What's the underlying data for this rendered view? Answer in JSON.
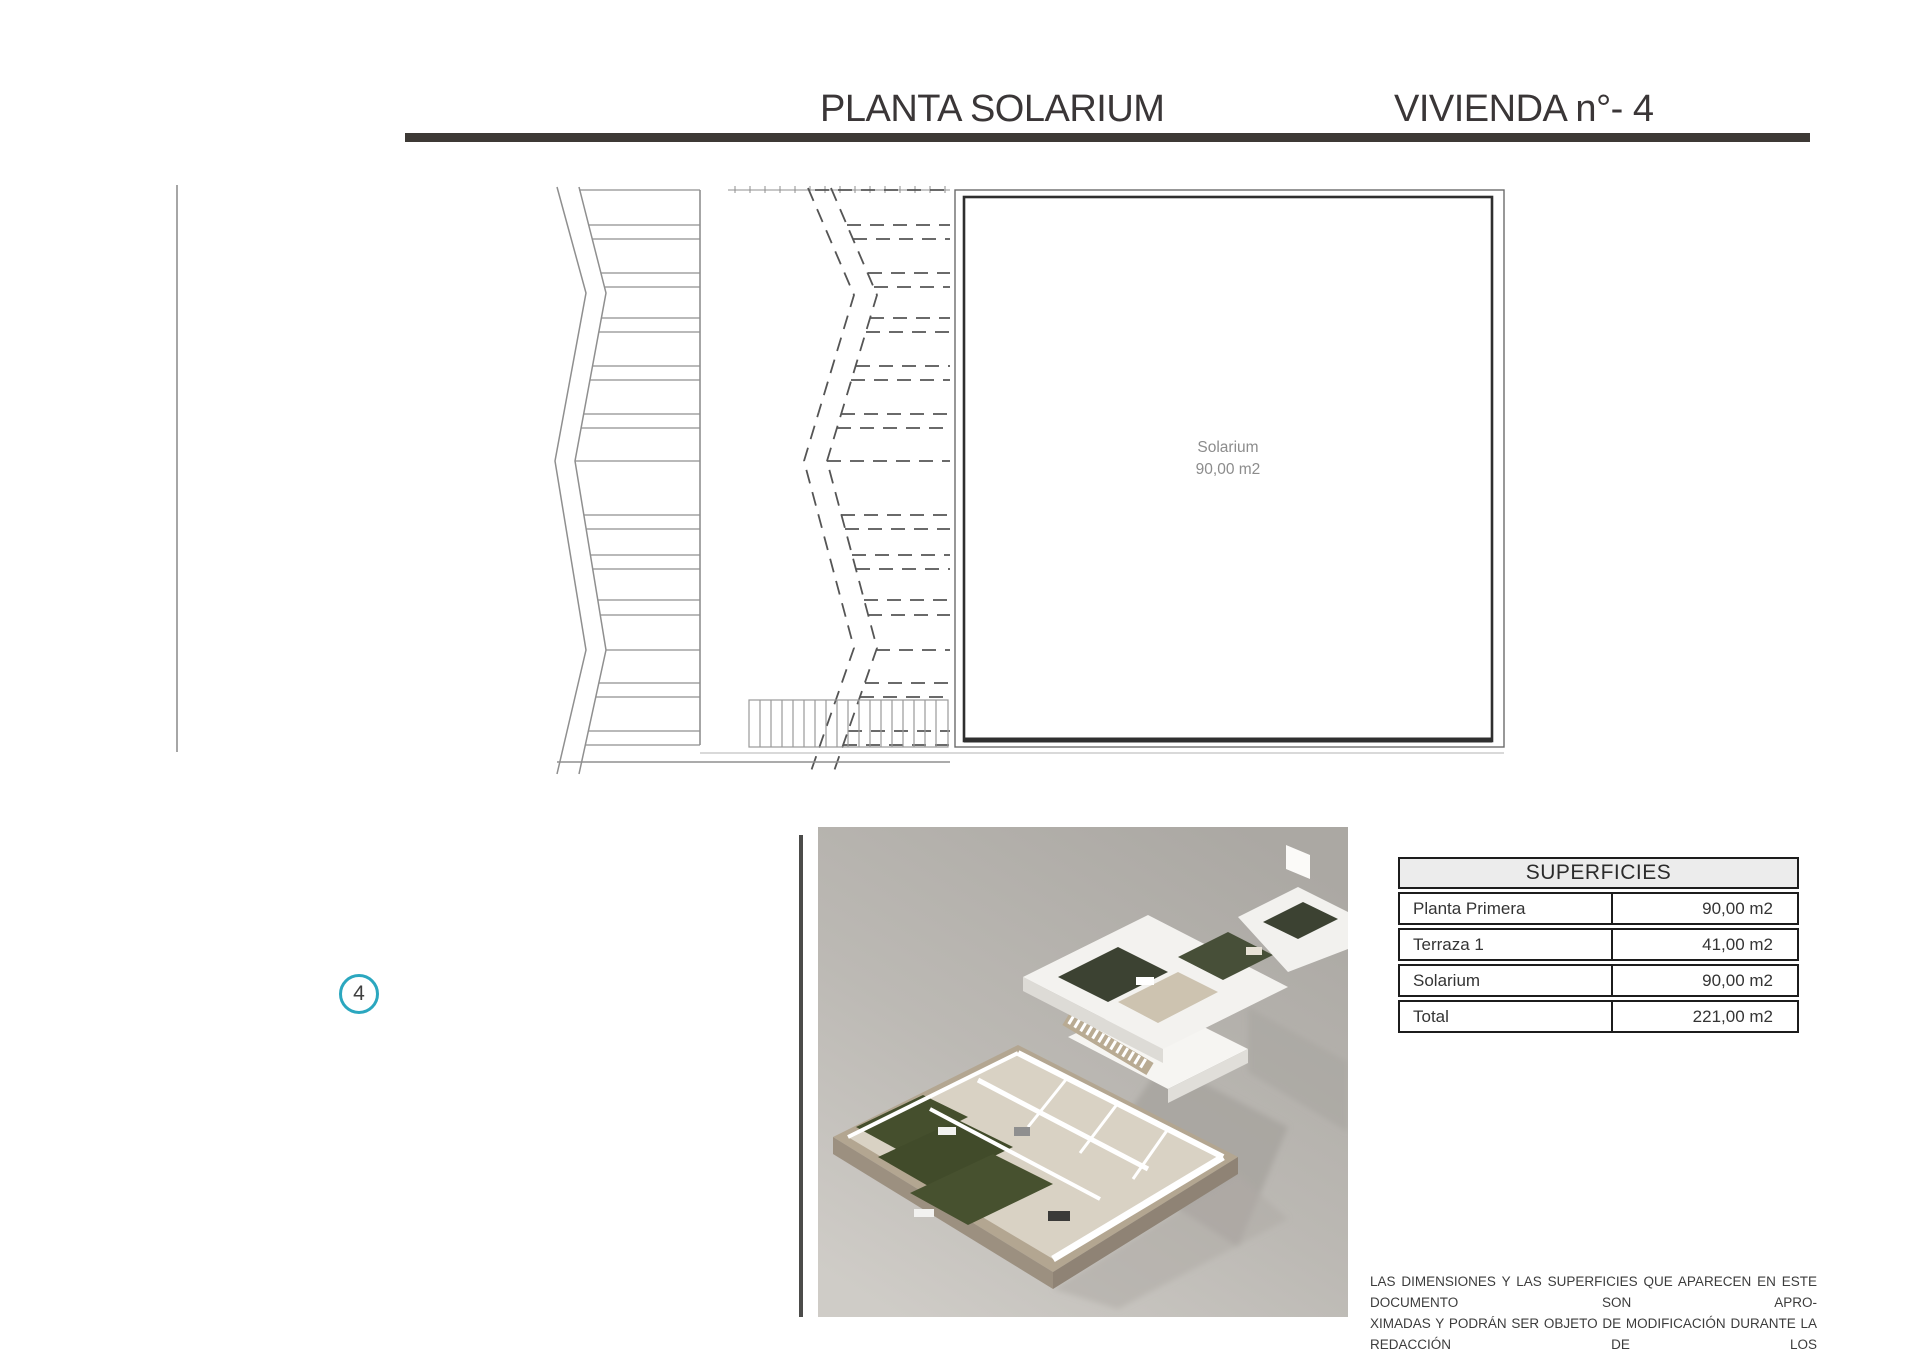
{
  "header": {
    "title_left": "PLANTA SOLARIUM",
    "title_right": "VIVIENDA n°- 4"
  },
  "plan": {
    "room_label": "Solarium",
    "room_area": "90,00 m2",
    "marker_number": "4"
  },
  "table": {
    "header": "SUPERFICIES",
    "rows": [
      {
        "label": "Planta Primera",
        "value": "90,00 m2"
      },
      {
        "label": "Terraza 1",
        "value": "41,00 m2"
      },
      {
        "label": "Solarium",
        "value": "90,00 m2"
      },
      {
        "label": "Total",
        "value": "221,00 m2"
      }
    ]
  },
  "disclaimer": {
    "lines": [
      "LAS DIMENSIONES Y LAS SUPERFICIES QUE APARECEN EN ESTE DOCUMENTO SON APRO-",
      "XIMADAS Y PODRÁN SER OBJETO DE MODIFICACIÓN DURANTE LA REDACCIÓN DE LOS",
      "PROYECTOS BÁSICO Y DE EJECUCIÓN"
    ]
  },
  "colors": {
    "accent_teal": "#2ba7bf",
    "bar_color": "#3d3935",
    "plan_line_light": "#8f8f8f",
    "plan_line_dark": "#555555",
    "box_line": "#2f2f2f",
    "render_bg_top": "#aba8a3",
    "render_bg_bottom": "#cfccc7",
    "garden_green": "#454f2d",
    "gravel_tan": "#b3a691",
    "floor_beige": "#d9d2c4"
  }
}
